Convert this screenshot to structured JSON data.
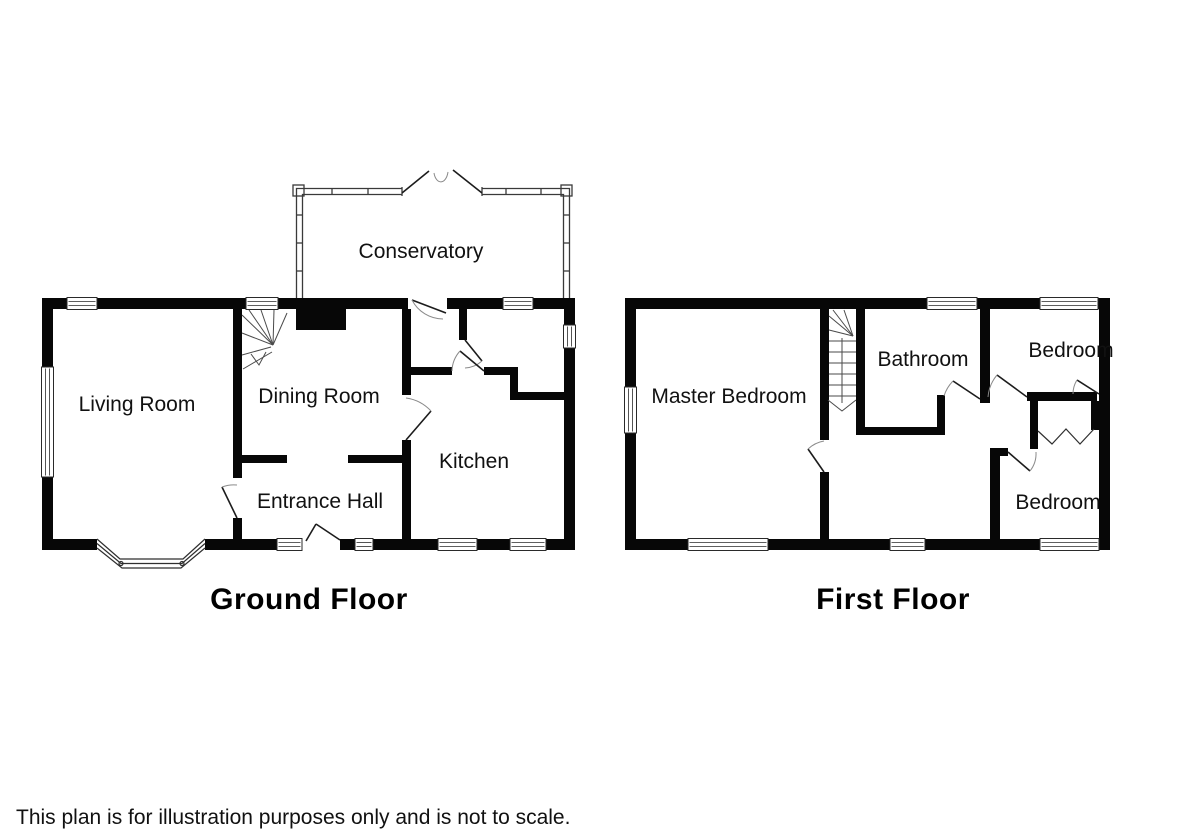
{
  "page": {
    "background": "#ffffff",
    "wall_color": "#070707",
    "line_color": "#2a2a2a",
    "disclaimer": "This plan is for illustration purposes only and is not to scale."
  },
  "floors": [
    {
      "title": "Ground Floor",
      "rooms": [
        {
          "label": "Conservatory"
        },
        {
          "label": "Living Room"
        },
        {
          "label": "Dining Room"
        },
        {
          "label": "Entrance Hall"
        },
        {
          "label": "Kitchen"
        }
      ]
    },
    {
      "title": "First Floor",
      "rooms": [
        {
          "label": "Master Bedroom"
        },
        {
          "label": "Bathroom"
        },
        {
          "label": "Bedroom"
        },
        {
          "label": "Bedroom"
        }
      ]
    }
  ]
}
